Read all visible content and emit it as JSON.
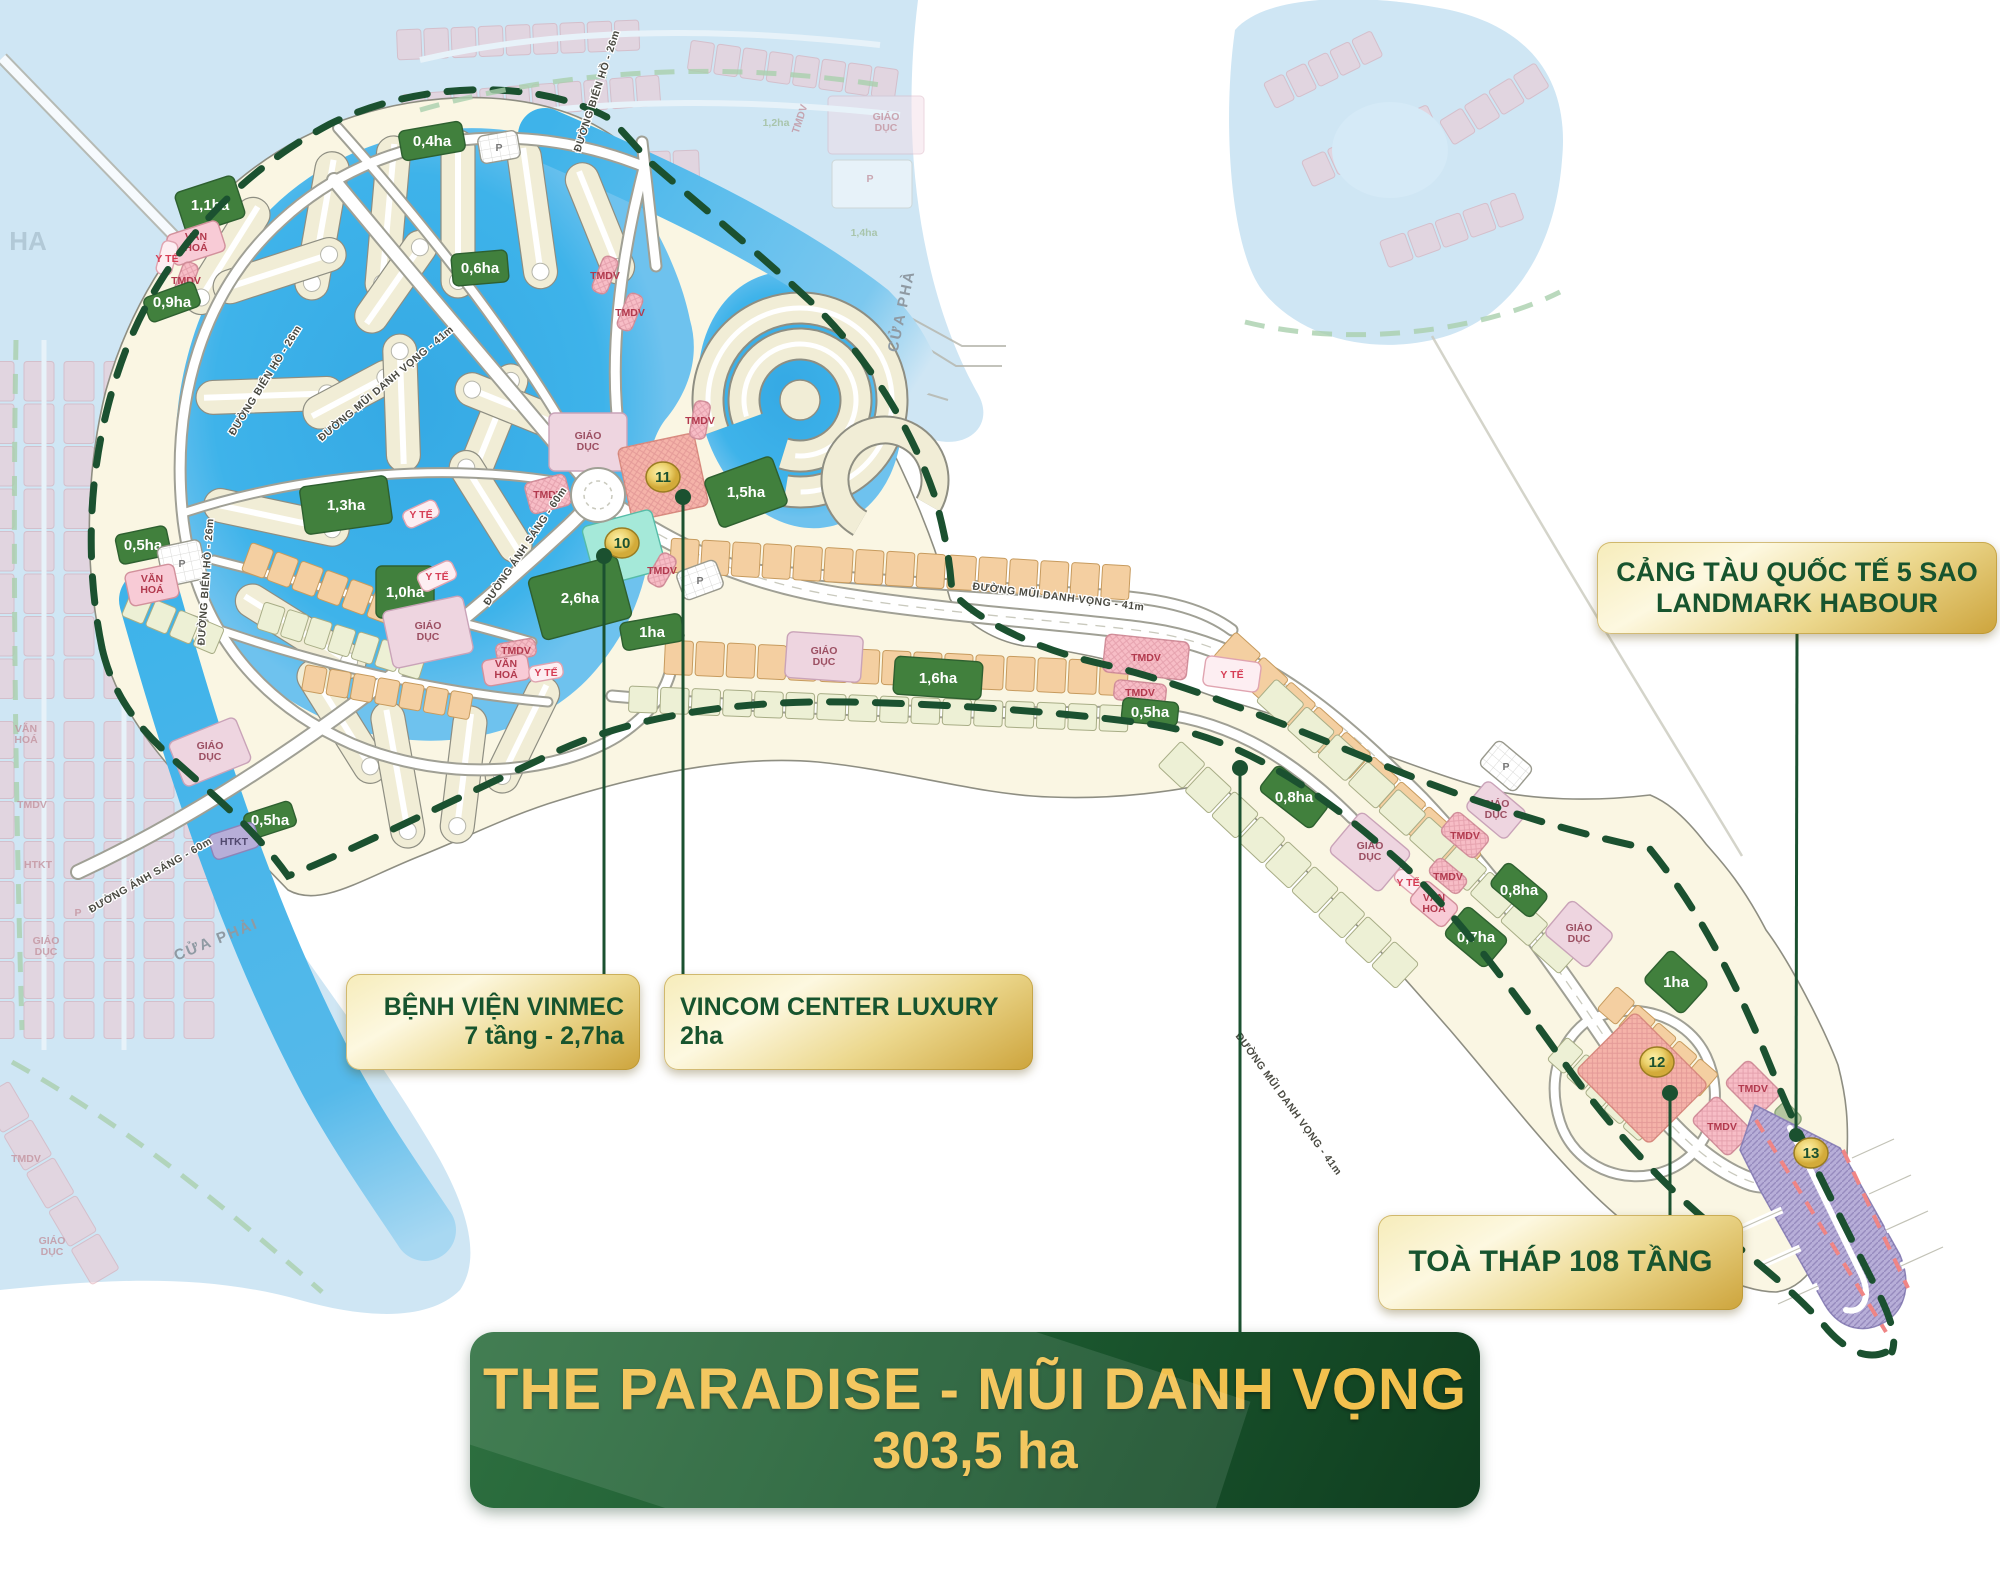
{
  "banner": {
    "title": "THE PARADISE - MŨI DANH VỌNG",
    "area": "303,5 ha"
  },
  "callouts": {
    "vinmec": {
      "line1": "BỆNH VIỆN VINMEC",
      "line2": "7 tầng - 2,7ha"
    },
    "vincom": {
      "line1": "VINCOM CENTER LUXURY",
      "line2": "2ha"
    },
    "harbour": {
      "line1": "CẢNG TÀU QUỐC TẾ 5 SAO",
      "line2": "LANDMARK HABOUR"
    },
    "tower": {
      "line1": "TOÀ THÁP 108 TẦNG"
    }
  },
  "map": {
    "markers": [
      {
        "n": "10",
        "x": 622,
        "y": 543
      },
      {
        "n": "11",
        "x": 663,
        "y": 477
      },
      {
        "n": "12",
        "x": 1657,
        "y": 1062
      },
      {
        "n": "13",
        "x": 1811,
        "y": 1153
      }
    ],
    "parcels": [
      {
        "x": 432,
        "y": 141,
        "w": 64,
        "h": 30,
        "rot": -10,
        "type": "park",
        "label": "0,4ha"
      },
      {
        "x": 499,
        "y": 147,
        "w": 40,
        "h": 28,
        "rot": -10,
        "type": "parking",
        "label": "P"
      },
      {
        "x": 210,
        "y": 205,
        "w": 62,
        "h": 44,
        "rot": -18,
        "type": "park",
        "label": "1,1ha"
      },
      {
        "x": 196,
        "y": 243,
        "w": 54,
        "h": 32,
        "rot": -18,
        "type": "culture",
        "label": "VĂN\nHOÁ"
      },
      {
        "x": 167,
        "y": 258,
        "w": 34,
        "h": 16,
        "rot": -75,
        "type": "medical",
        "label": "Y TẾ"
      },
      {
        "x": 186,
        "y": 280,
        "w": 36,
        "h": 16,
        "rot": -70,
        "type": "commerce",
        "label": "TMDV"
      },
      {
        "x": 172,
        "y": 302,
        "w": 54,
        "h": 26,
        "rot": -20,
        "type": "park",
        "label": "0,9ha"
      },
      {
        "x": 480,
        "y": 268,
        "w": 56,
        "h": 32,
        "rot": -5,
        "type": "park",
        "label": "0,6ha"
      },
      {
        "x": 346,
        "y": 505,
        "w": 88,
        "h": 48,
        "rot": -8,
        "type": "park",
        "label": "1,3ha"
      },
      {
        "x": 143,
        "y": 545,
        "w": 52,
        "h": 30,
        "rot": -12,
        "type": "park",
        "label": "0,5ha"
      },
      {
        "x": 182,
        "y": 563,
        "w": 44,
        "h": 40,
        "rot": -12,
        "type": "parking",
        "label": "P"
      },
      {
        "x": 152,
        "y": 585,
        "w": 50,
        "h": 34,
        "rot": -12,
        "type": "culture",
        "label": "VĂN\nHOÁ"
      },
      {
        "x": 405,
        "y": 592,
        "w": 58,
        "h": 52,
        "rot": 0,
        "type": "park",
        "label": "1,0ha"
      },
      {
        "x": 437,
        "y": 576,
        "w": 38,
        "h": 20,
        "rot": -25,
        "type": "medical",
        "label": "Y TẾ"
      },
      {
        "x": 428,
        "y": 632,
        "w": 82,
        "h": 58,
        "rot": -12,
        "type": "school",
        "label": "GIÁO\nDỤC"
      },
      {
        "x": 588,
        "y": 442,
        "w": 78,
        "h": 58,
        "rot": 0,
        "type": "school",
        "label": "GIÁO\nDỤC"
      },
      {
        "x": 548,
        "y": 494,
        "w": 42,
        "h": 32,
        "rot": -15,
        "type": "commerce",
        "label": "TMDV"
      },
      {
        "x": 663,
        "y": 477,
        "w": 78,
        "h": 74,
        "rot": -12,
        "type": "pink",
        "label": ""
      },
      {
        "x": 624,
        "y": 548,
        "w": 72,
        "h": 62,
        "rot": -15,
        "type": "mint",
        "label": ""
      },
      {
        "x": 580,
        "y": 598,
        "w": 92,
        "h": 64,
        "rot": -15,
        "type": "park",
        "label": "2,6ha"
      },
      {
        "x": 746,
        "y": 492,
        "w": 72,
        "h": 52,
        "rot": -20,
        "type": "park",
        "label": "1,5ha"
      },
      {
        "x": 652,
        "y": 632,
        "w": 62,
        "h": 28,
        "rot": -10,
        "type": "park",
        "label": "1ha"
      },
      {
        "x": 700,
        "y": 580,
        "w": 42,
        "h": 30,
        "rot": -20,
        "type": "parking",
        "label": "P"
      },
      {
        "x": 662,
        "y": 570,
        "w": 34,
        "h": 18,
        "rot": -60,
        "type": "commerce",
        "label": "TMDV"
      },
      {
        "x": 605,
        "y": 275,
        "w": 38,
        "h": 16,
        "rot": -68,
        "type": "commerce",
        "label": "TMDV"
      },
      {
        "x": 630,
        "y": 312,
        "w": 38,
        "h": 16,
        "rot": -68,
        "type": "commerce",
        "label": "TMDV"
      },
      {
        "x": 700,
        "y": 420,
        "w": 38,
        "h": 16,
        "rot": -80,
        "type": "commerce",
        "label": "TMDV"
      },
      {
        "x": 421,
        "y": 514,
        "w": 36,
        "h": 18,
        "rot": -25,
        "type": "medical",
        "label": "Y TẾ"
      },
      {
        "x": 516,
        "y": 650,
        "w": 40,
        "h": 18,
        "rot": -10,
        "type": "commerce",
        "label": "TMDV"
      },
      {
        "x": 506,
        "y": 670,
        "w": 46,
        "h": 26,
        "rot": -10,
        "type": "culture",
        "label": "VĂN\nHOÁ"
      },
      {
        "x": 546,
        "y": 672,
        "w": 34,
        "h": 16,
        "rot": -10,
        "type": "medical",
        "label": "Y TẾ"
      },
      {
        "x": 210,
        "y": 752,
        "w": 72,
        "h": 48,
        "rot": -22,
        "type": "school",
        "label": "GIÁO\nDỤC"
      },
      {
        "x": 270,
        "y": 820,
        "w": 50,
        "h": 26,
        "rot": -18,
        "type": "park",
        "label": "0,5ha"
      },
      {
        "x": 234,
        "y": 841,
        "w": 48,
        "h": 26,
        "rot": -18,
        "type": "htkt",
        "label": "HTKT"
      },
      {
        "x": 824,
        "y": 657,
        "w": 76,
        "h": 46,
        "rot": 4,
        "type": "school",
        "label": "GIÁO\nDỤC"
      },
      {
        "x": 938,
        "y": 678,
        "w": 88,
        "h": 38,
        "rot": 4,
        "type": "park",
        "label": "1,6ha"
      },
      {
        "x": 1146,
        "y": 657,
        "w": 84,
        "h": 38,
        "rot": 6,
        "type": "commerce",
        "label": "TMDV"
      },
      {
        "x": 1232,
        "y": 674,
        "w": 56,
        "h": 30,
        "rot": 8,
        "type": "medical",
        "label": "Y TẾ"
      },
      {
        "x": 1140,
        "y": 692,
        "w": 52,
        "h": 20,
        "rot": 6,
        "type": "commerce",
        "label": "TMDV"
      },
      {
        "x": 1150,
        "y": 712,
        "w": 56,
        "h": 24,
        "rot": 6,
        "type": "park",
        "label": "0,5ha"
      },
      {
        "x": 1294,
        "y": 797,
        "w": 66,
        "h": 32,
        "rot": 38,
        "type": "park",
        "label": "0,8ha"
      },
      {
        "x": 1370,
        "y": 852,
        "w": 66,
        "h": 52,
        "rot": 40,
        "type": "school",
        "label": "GIÁO\nDỤC"
      },
      {
        "x": 1408,
        "y": 882,
        "w": 30,
        "h": 14,
        "rot": 40,
        "type": "medical",
        "label": "Y TẾ"
      },
      {
        "x": 1434,
        "y": 904,
        "w": 44,
        "h": 28,
        "rot": 40,
        "type": "culture",
        "label": "VĂN\nHOÁ"
      },
      {
        "x": 1448,
        "y": 876,
        "w": 38,
        "h": 20,
        "rot": 40,
        "type": "commerce",
        "label": "TMDV"
      },
      {
        "x": 1476,
        "y": 937,
        "w": 54,
        "h": 38,
        "rot": 40,
        "type": "park",
        "label": "0,7ha"
      },
      {
        "x": 1465,
        "y": 835,
        "w": 44,
        "h": 28,
        "rot": 40,
        "type": "commerce",
        "label": "TMDV"
      },
      {
        "x": 1519,
        "y": 890,
        "w": 54,
        "h": 30,
        "rot": 40,
        "type": "park",
        "label": "0,8ha"
      },
      {
        "x": 1579,
        "y": 934,
        "w": 56,
        "h": 44,
        "rot": 40,
        "type": "school",
        "label": "GIÁO\nDỤC"
      },
      {
        "x": 1506,
        "y": 766,
        "w": 46,
        "h": 32,
        "rot": 40,
        "type": "parking",
        "label": "P"
      },
      {
        "x": 1496,
        "y": 810,
        "w": 52,
        "h": 36,
        "rot": 40,
        "type": "school",
        "label": "GIÁO\nDỤC"
      },
      {
        "x": 1676,
        "y": 982,
        "w": 52,
        "h": 42,
        "rot": 42,
        "type": "park",
        "label": "1ha"
      },
      {
        "x": 1642,
        "y": 1078,
        "w": 104,
        "h": 84,
        "rot": 45,
        "type": "pink",
        "label": ""
      },
      {
        "x": 1753,
        "y": 1088,
        "w": 48,
        "h": 34,
        "rot": 45,
        "type": "commerce",
        "label": "TMDV"
      },
      {
        "x": 1722,
        "y": 1126,
        "w": 52,
        "h": 36,
        "rot": 45,
        "type": "commerce",
        "label": "TMDV"
      },
      {
        "x": 1788,
        "y": 1116,
        "w": 26,
        "h": 18,
        "rot": 45,
        "type": "sage",
        "label": ""
      }
    ],
    "road_labels": [
      {
        "t": "ĐƯỜNG BIỂN HỒ - 26m",
        "x": 600,
        "y": 92,
        "r": -72
      },
      {
        "t": "ĐƯỜNG BIỂN HỒ - 26m",
        "x": 268,
        "y": 382,
        "r": -58
      },
      {
        "t": "ĐƯỜNG BIỂN HỒ - 26m",
        "x": 209,
        "y": 582,
        "r": -86
      },
      {
        "t": "ĐƯỜNG MŨI DANH VỌNG - 41m",
        "x": 388,
        "y": 386,
        "r": -40
      },
      {
        "t": "ĐƯỜNG MŨI DANH VỌNG - 41m",
        "x": 1058,
        "y": 600,
        "r": 7
      },
      {
        "t": "ĐƯỜNG MŨI DANH VỌNG - 41m",
        "x": 1286,
        "y": 1106,
        "r": 54
      },
      {
        "t": "ĐƯỜNG ÁNH SÁNG - 60m",
        "x": 528,
        "y": 548,
        "r": -56
      },
      {
        "t": "ĐƯỜNG ÁNH SÁNG - 60m",
        "x": 152,
        "y": 878,
        "r": -30
      }
    ],
    "water_labels": [
      {
        "t": "CỬA PHÀ",
        "x": 906,
        "y": 312,
        "r": -78
      },
      {
        "t": "CỬA PHẢI",
        "x": 218,
        "y": 944,
        "r": -22
      }
    ],
    "ghost_labels": [
      {
        "t": "GIÁO\nDỤC",
        "x": 886,
        "y": 120
      },
      {
        "t": "P",
        "x": 870,
        "y": 182
      },
      {
        "t": "1,4ha",
        "x": 864,
        "y": 236,
        "c": "green"
      },
      {
        "t": "TMDV",
        "x": 803,
        "y": 120,
        "r": -72
      },
      {
        "t": "1,2ha",
        "x": 776,
        "y": 126,
        "c": "green"
      },
      {
        "t": "VĂN\nHOÁ",
        "x": 26,
        "y": 732
      },
      {
        "t": "TMDV",
        "x": 32,
        "y": 808
      },
      {
        "t": "HTKT",
        "x": 38,
        "y": 868
      },
      {
        "t": "P",
        "x": 78,
        "y": 916
      },
      {
        "t": "GIÁO\nDỤC",
        "x": 46,
        "y": 944
      },
      {
        "t": "TMDV",
        "x": 26,
        "y": 1162
      },
      {
        "t": "GIÁO\nDỤC",
        "x": 52,
        "y": 1244
      },
      {
        "t": "HA",
        "x": 28,
        "y": 250,
        "big": true
      }
    ]
  },
  "colors": {
    "boundary_green": "#1b5130",
    "banner_green": "#1c5a30",
    "gold_text": "#f2c14e",
    "callout_gold": "#e8cf82",
    "water_pale": "#cfe6f4",
    "water_bright": "#3eb3ea",
    "sand": "#faf6e3",
    "park_green": "#41803d",
    "lot_peach": "#f4cfa1",
    "lot_pale": "#edf0d5",
    "tmdv_pink": "#f7bdc6",
    "pier_purple": "#b7aed8"
  }
}
